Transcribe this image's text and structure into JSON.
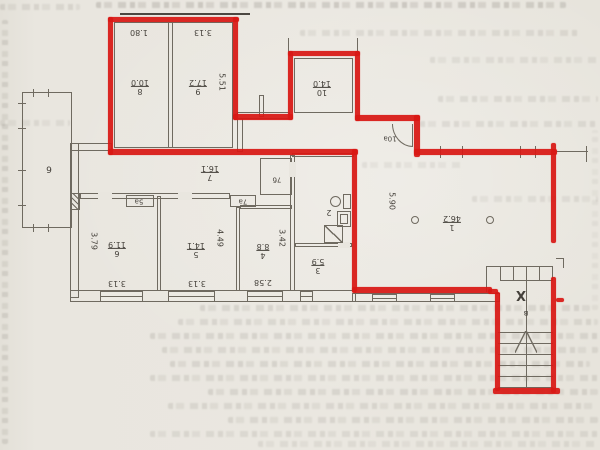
{
  "plan": {
    "red_color": "#d91915",
    "rooms": {
      "r1": {
        "number": "1",
        "area": "46.2",
        "dim_v": "5.90"
      },
      "r2": {
        "number": "2"
      },
      "r3": {
        "number": "3",
        "area": "5.9"
      },
      "r4": {
        "number": "4",
        "area": "8.8",
        "dim_v": "3.42",
        "dim_h": "2.58"
      },
      "r5": {
        "number": "5",
        "area": "14.1",
        "dim_v": "4.49",
        "dim_h": "3.13"
      },
      "r6": {
        "number": "6",
        "area": "11.9",
        "dim_v": "3.79",
        "dim_h": "3.13"
      },
      "r7": {
        "number": "7",
        "area": "16.1"
      },
      "r8": {
        "number": "8",
        "area": "10.0",
        "dim_top": "1.80"
      },
      "r9": {
        "number": "9",
        "area": "17.2",
        "dim_top": "3.13",
        "dim_side": "5.51"
      },
      "r10": {
        "number": "10",
        "area": "14.0"
      },
      "r10a": {
        "number": "10а"
      },
      "r5a": {
        "number": "5а"
      },
      "r7a": {
        "number": "7а"
      },
      "r7b": {
        "number": "7б"
      },
      "loggia": {
        "number": "6"
      },
      "staircase": {
        "mark": "X",
        "letter": "в"
      }
    }
  }
}
